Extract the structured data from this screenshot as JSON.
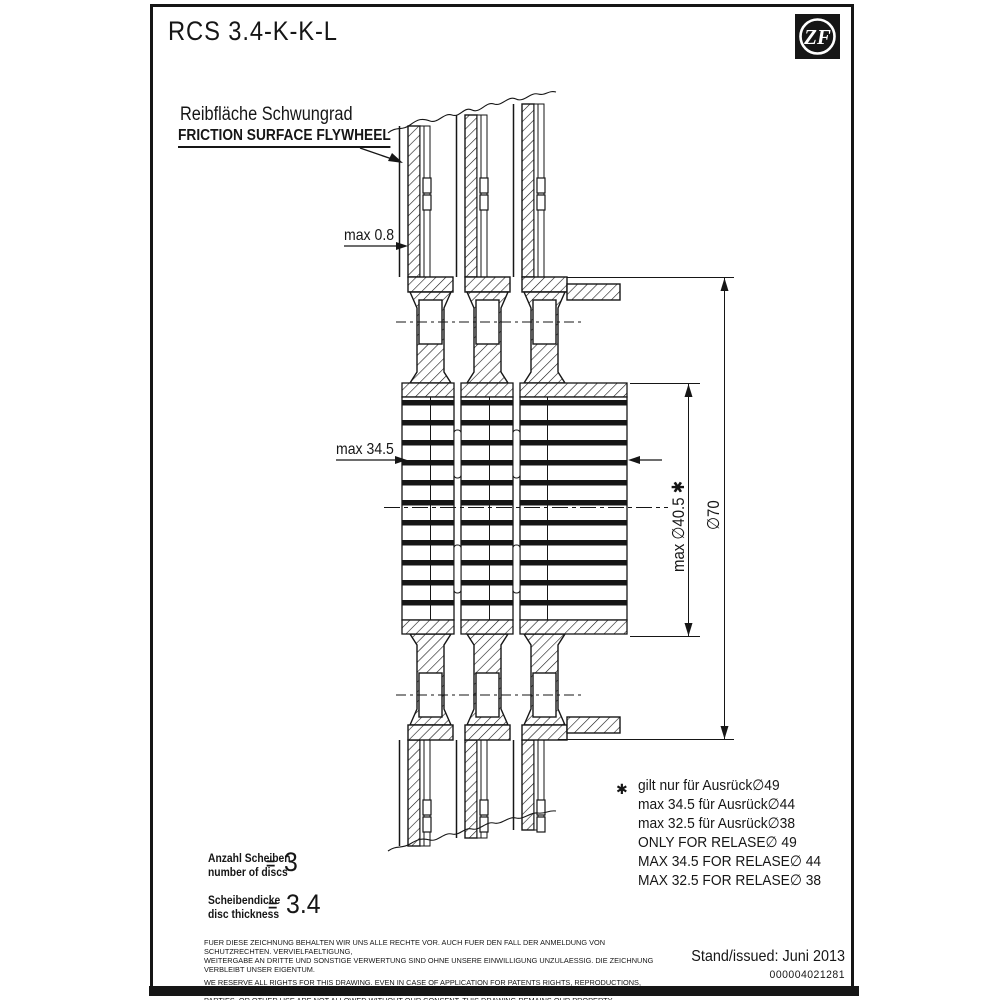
{
  "colors": {
    "ink": "#161616",
    "paper": "#ffffff"
  },
  "header": {
    "title": "RCS 3.4-K-K-L",
    "logo_text": "ZF"
  },
  "labels": {
    "friction_de": "Reibfläche Schwungrad",
    "friction_en": "FRICTION SURFACE FLYWHEEL"
  },
  "dims": {
    "max_08": "max 0.8",
    "max_345": "max 34.5",
    "d405": "max ∅40.5 ✱",
    "d70": "∅70"
  },
  "notes": {
    "asterisk": "✱",
    "lines": [
      "gilt nur für Ausrück∅49",
      "max 34.5 für Ausrück∅44",
      "max 32.5 für Ausrück∅38",
      "ONLY FOR RELASE∅ 49",
      "MAX 34.5 FOR RELASE∅ 44",
      "MAX 32.5 FOR RELASE∅ 38"
    ]
  },
  "discs": {
    "label_de": "Anzahl Scheiben",
    "label_en": "number of discs",
    "equals": "=",
    "value": "3"
  },
  "thickness": {
    "label_de": "Scheibendicke",
    "label_en": "disc thickness",
    "equals": "=",
    "value": "3.4"
  },
  "legal": {
    "lines": [
      "FUER DIESE ZEICHNUNG BEHALTEN WIR UNS ALLE RECHTE VOR. AUCH FUER DEN FALL DER ANMELDUNG VON SCHUTZRECHTEN. VERVIELFAELTIGUNG,",
      "WEITERGABE AN DRITTE UND SONSTIGE VERWERTUNG SIND OHNE UNSERE EINWILLIGUNG UNZULAESSIG. DIE ZEICHNUNG VERBLEIBT UNSER EIGENTUM.",
      "WE RESERVE ALL RIGHTS FOR THIS DRAWING. EVEN IN CASE OF APPLICATION FOR PATENTS RIGHTS, REPRODUCTIONS, TRANSMITTAL TO THIRD",
      "PARTIES, OR OTHER USE ARE NOT ALLOWED WITHOUT OUR CONSENT. THIS DRAWING REMAINS OUR PROPERTY."
    ]
  },
  "footer": {
    "issued": "Stand/issued: Juni 2013",
    "doc_number": "000004021281"
  }
}
